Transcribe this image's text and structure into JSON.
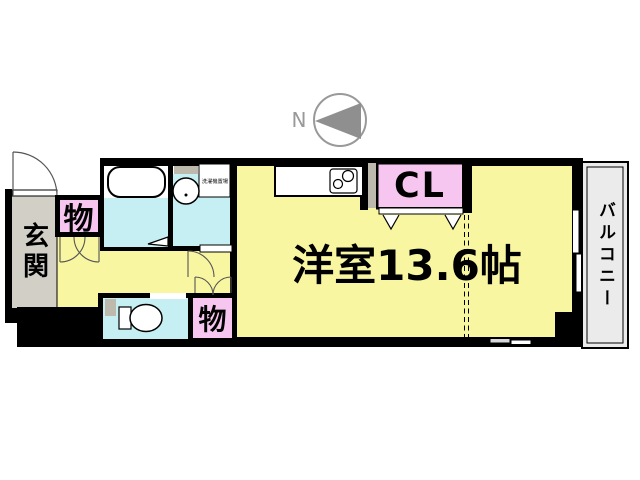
{
  "compass": {
    "north_label": "N"
  },
  "labels": {
    "genkan": "玄関",
    "storage_upper": "物",
    "storage_lower": "物",
    "closet": "CL",
    "main_room": "洋室13.6帖",
    "balcony": "バルコニー",
    "laundry_space": "洗濯機置場"
  },
  "colors": {
    "room_yellow": "#F9F6A2",
    "wet_cyan": "#C5EFF2",
    "storage_pink": "#F6C6F0",
    "genkan_gray": "#D2CFC6",
    "balcony_gray": "#EBEBEB",
    "fixture_gray": "#BDB9AC",
    "wall_black": "#000000",
    "compass_gray": "#8F8F8F"
  }
}
